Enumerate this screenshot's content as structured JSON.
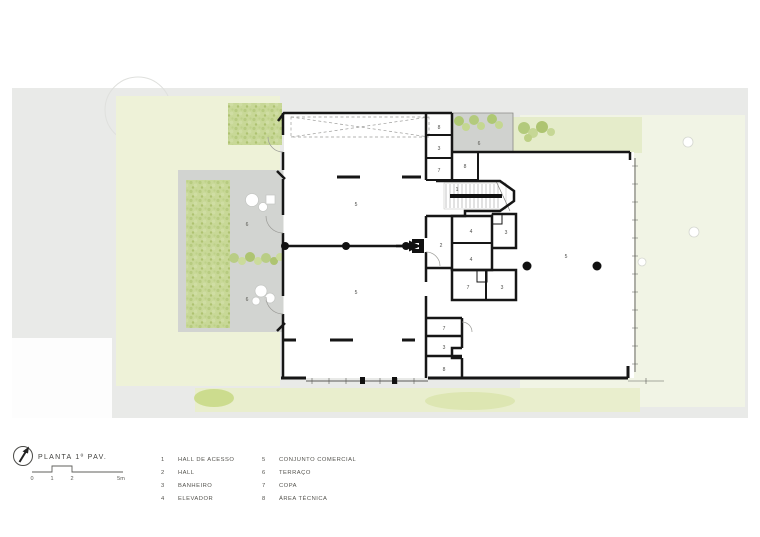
{
  "document": {
    "type": "architectural floor plan",
    "language": "pt-BR"
  },
  "title_block": {
    "title": "PLANTA 1º PAV.",
    "north_icon": "north-arrow-icon",
    "scale_bar": {
      "ticks": [
        "0",
        "1",
        "2",
        "5m"
      ]
    }
  },
  "legend": {
    "items": [
      {
        "num": "1",
        "label": "HALL DE ACESSO"
      },
      {
        "num": "2",
        "label": "HALL"
      },
      {
        "num": "3",
        "label": "BANHEIRO"
      },
      {
        "num": "4",
        "label": "ELEVADOR"
      },
      {
        "num": "5",
        "label": "CONJUNTO COMERCIAL"
      },
      {
        "num": "6",
        "label": "TERRAÇO"
      },
      {
        "num": "7",
        "label": "COPA"
      },
      {
        "num": "8",
        "label": "ÁREA TÉCNICA"
      }
    ]
  },
  "plan": {
    "room_labels": [
      {
        "text": "5",
        "room": "conjunto-comercial-upper-left"
      },
      {
        "text": "5",
        "room": "conjunto-comercial-lower-left"
      },
      {
        "text": "5",
        "room": "conjunto-comercial-right"
      },
      {
        "text": "6",
        "room": "terraco-left-upper"
      },
      {
        "text": "6",
        "room": "terraco-left-lower"
      },
      {
        "text": "6",
        "room": "terraco-top"
      },
      {
        "text": "8",
        "room": "area-tecnica-core-top"
      },
      {
        "text": "3",
        "room": "banheiro-core-top"
      },
      {
        "text": "7",
        "room": "copa-core-top"
      },
      {
        "text": "8",
        "room": "area-tecnica-shaft"
      },
      {
        "text": "1",
        "room": "hall-de-acesso-stair"
      },
      {
        "text": "2",
        "room": "hall-entry"
      },
      {
        "text": "4",
        "room": "elevador-1"
      },
      {
        "text": "4",
        "room": "elevador-2"
      },
      {
        "text": "3",
        "room": "banheiro-core-mid"
      },
      {
        "text": "7",
        "room": "copa-core-right"
      },
      {
        "text": "3",
        "room": "banheiro-core-right"
      },
      {
        "text": "7",
        "room": "copa-bottom-stack"
      },
      {
        "text": "3",
        "room": "banheiro-bottom-stack"
      },
      {
        "text": "8",
        "room": "area-tecnica-bottom-stack"
      }
    ]
  },
  "colors": {
    "site_gray": "#e9eae8",
    "terrace_gray": "#d2d4d1",
    "lawn_pale": "#eef2d8",
    "lawn_pale_right": "#f1f4e5",
    "vegetation_green": "#c3d492",
    "wall_black": "#161616",
    "text_gray": "#54534e"
  }
}
